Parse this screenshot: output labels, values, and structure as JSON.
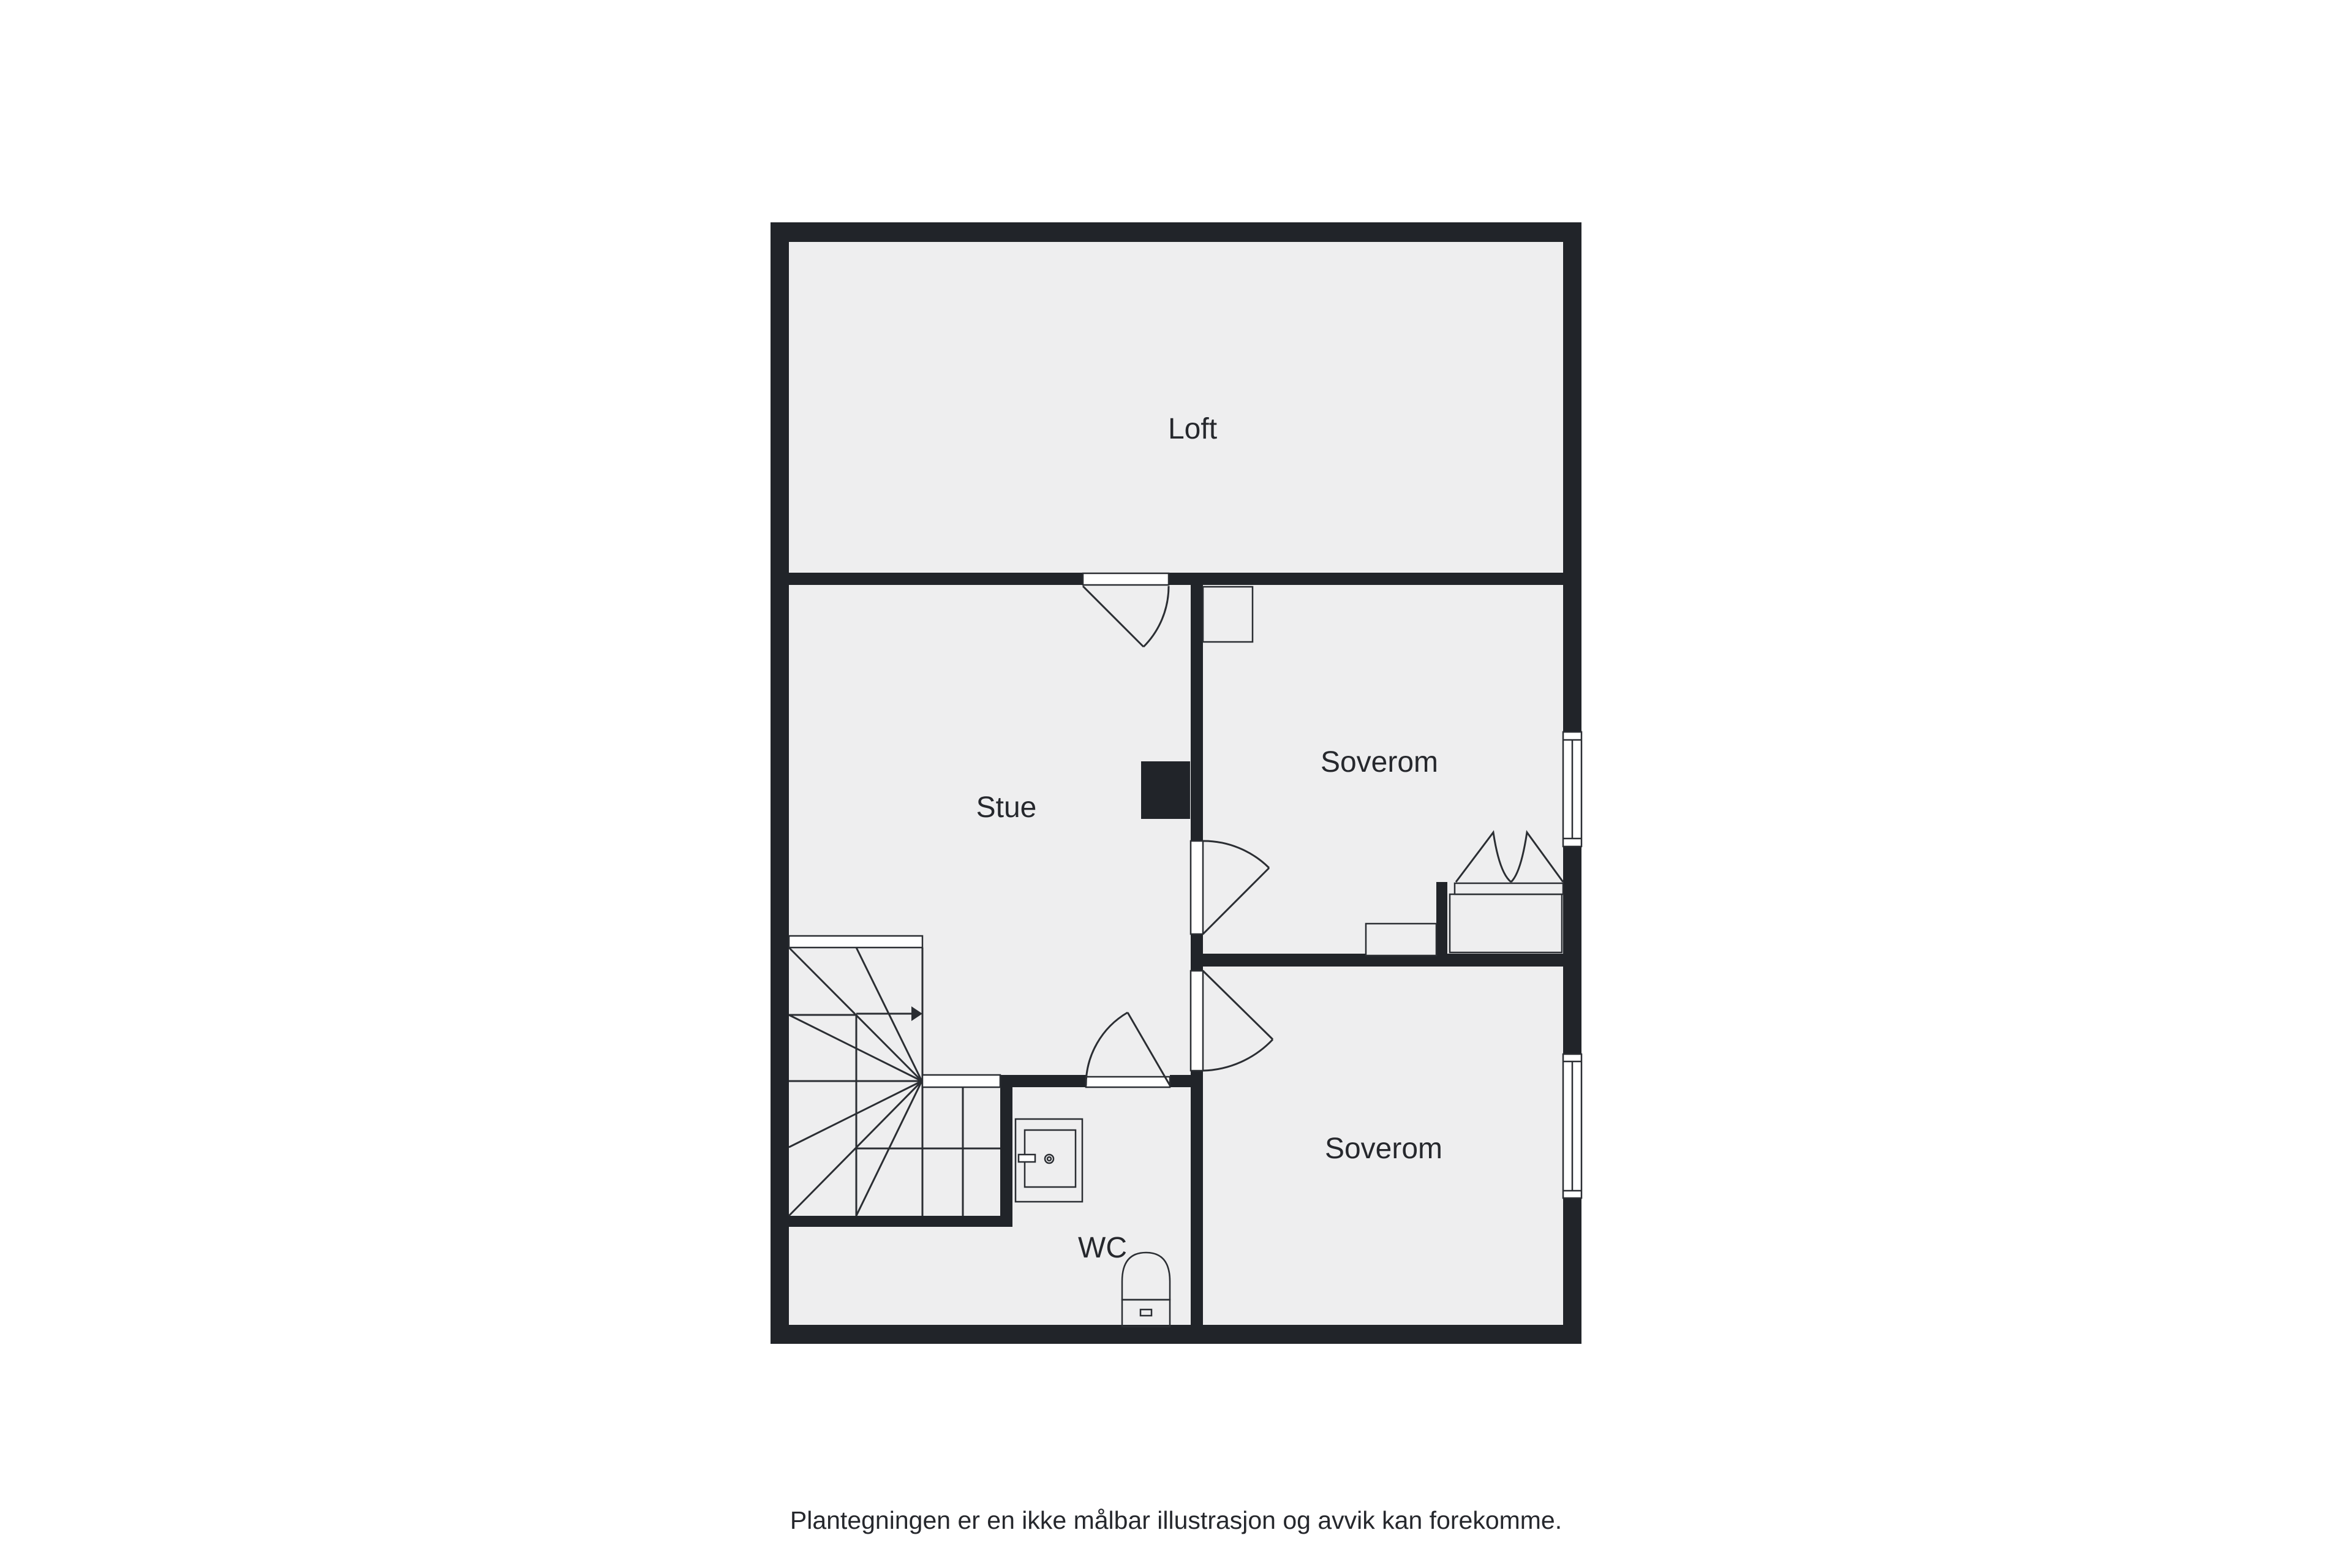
{
  "floorplan": {
    "rooms": [
      {
        "label": "Loft"
      },
      {
        "label": "Stue"
      },
      {
        "label": "Soverom"
      },
      {
        "label": "Soverom"
      },
      {
        "label": "WC"
      }
    ],
    "disclaimer": "Plantegningen er en ikke målbar illustrasjon og avvik kan forekomme.",
    "colors": {
      "background": "#ffffff",
      "floor": "#eeeeef",
      "wall": "#212429",
      "line": "#2b2e33",
      "text": "#26282d"
    },
    "icons": {
      "doors": "door-swing-arc",
      "windows": "window-symbol",
      "stairs": "winder-staircase-with-direction-arrow",
      "fixtures": [
        "washbasin-icon",
        "toilet-icon",
        "chimney-block"
      ]
    }
  }
}
